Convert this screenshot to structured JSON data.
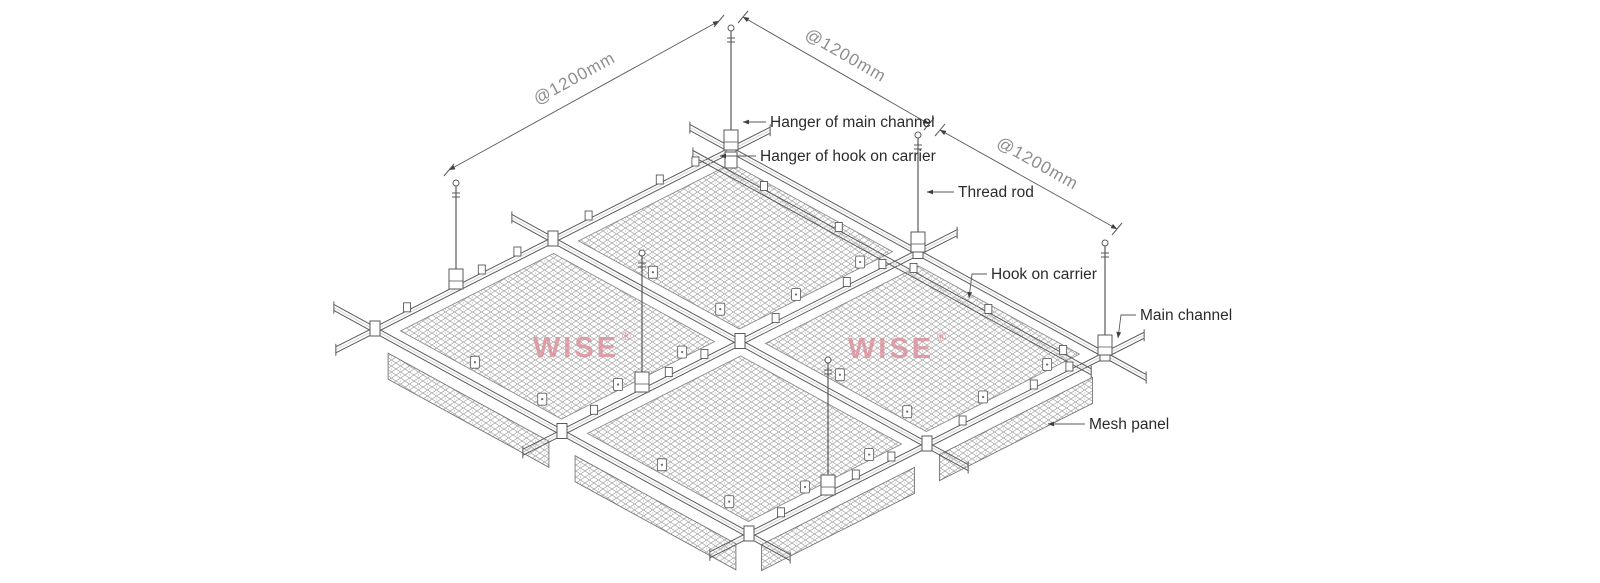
{
  "diagram": {
    "dimension_labels": [
      "@1200mm",
      "@1200mm",
      "@1200mm"
    ],
    "part_labels": {
      "hanger_main_channel": "Hanger of main channel",
      "hanger_hook_on_carrier": "Hanger of hook on carrier",
      "thread_rod": "Thread rod",
      "hook_on_carrier": "Hook on carrier",
      "main_channel": "Main channel",
      "mesh_panel": "Mesh panel"
    },
    "watermarks": [
      {
        "text": "WISE",
        "mark": "®"
      },
      {
        "text": "WISE",
        "mark": "®"
      }
    ],
    "colors": {
      "line": "#5a5a5a",
      "ink": "#2b2b2b",
      "dim_text": "#8d8d8d",
      "watermark": "#dc8d98",
      "mesh": "#9c9c9c",
      "arrow": "#3f3f3f",
      "background": "#ffffff"
    }
  }
}
